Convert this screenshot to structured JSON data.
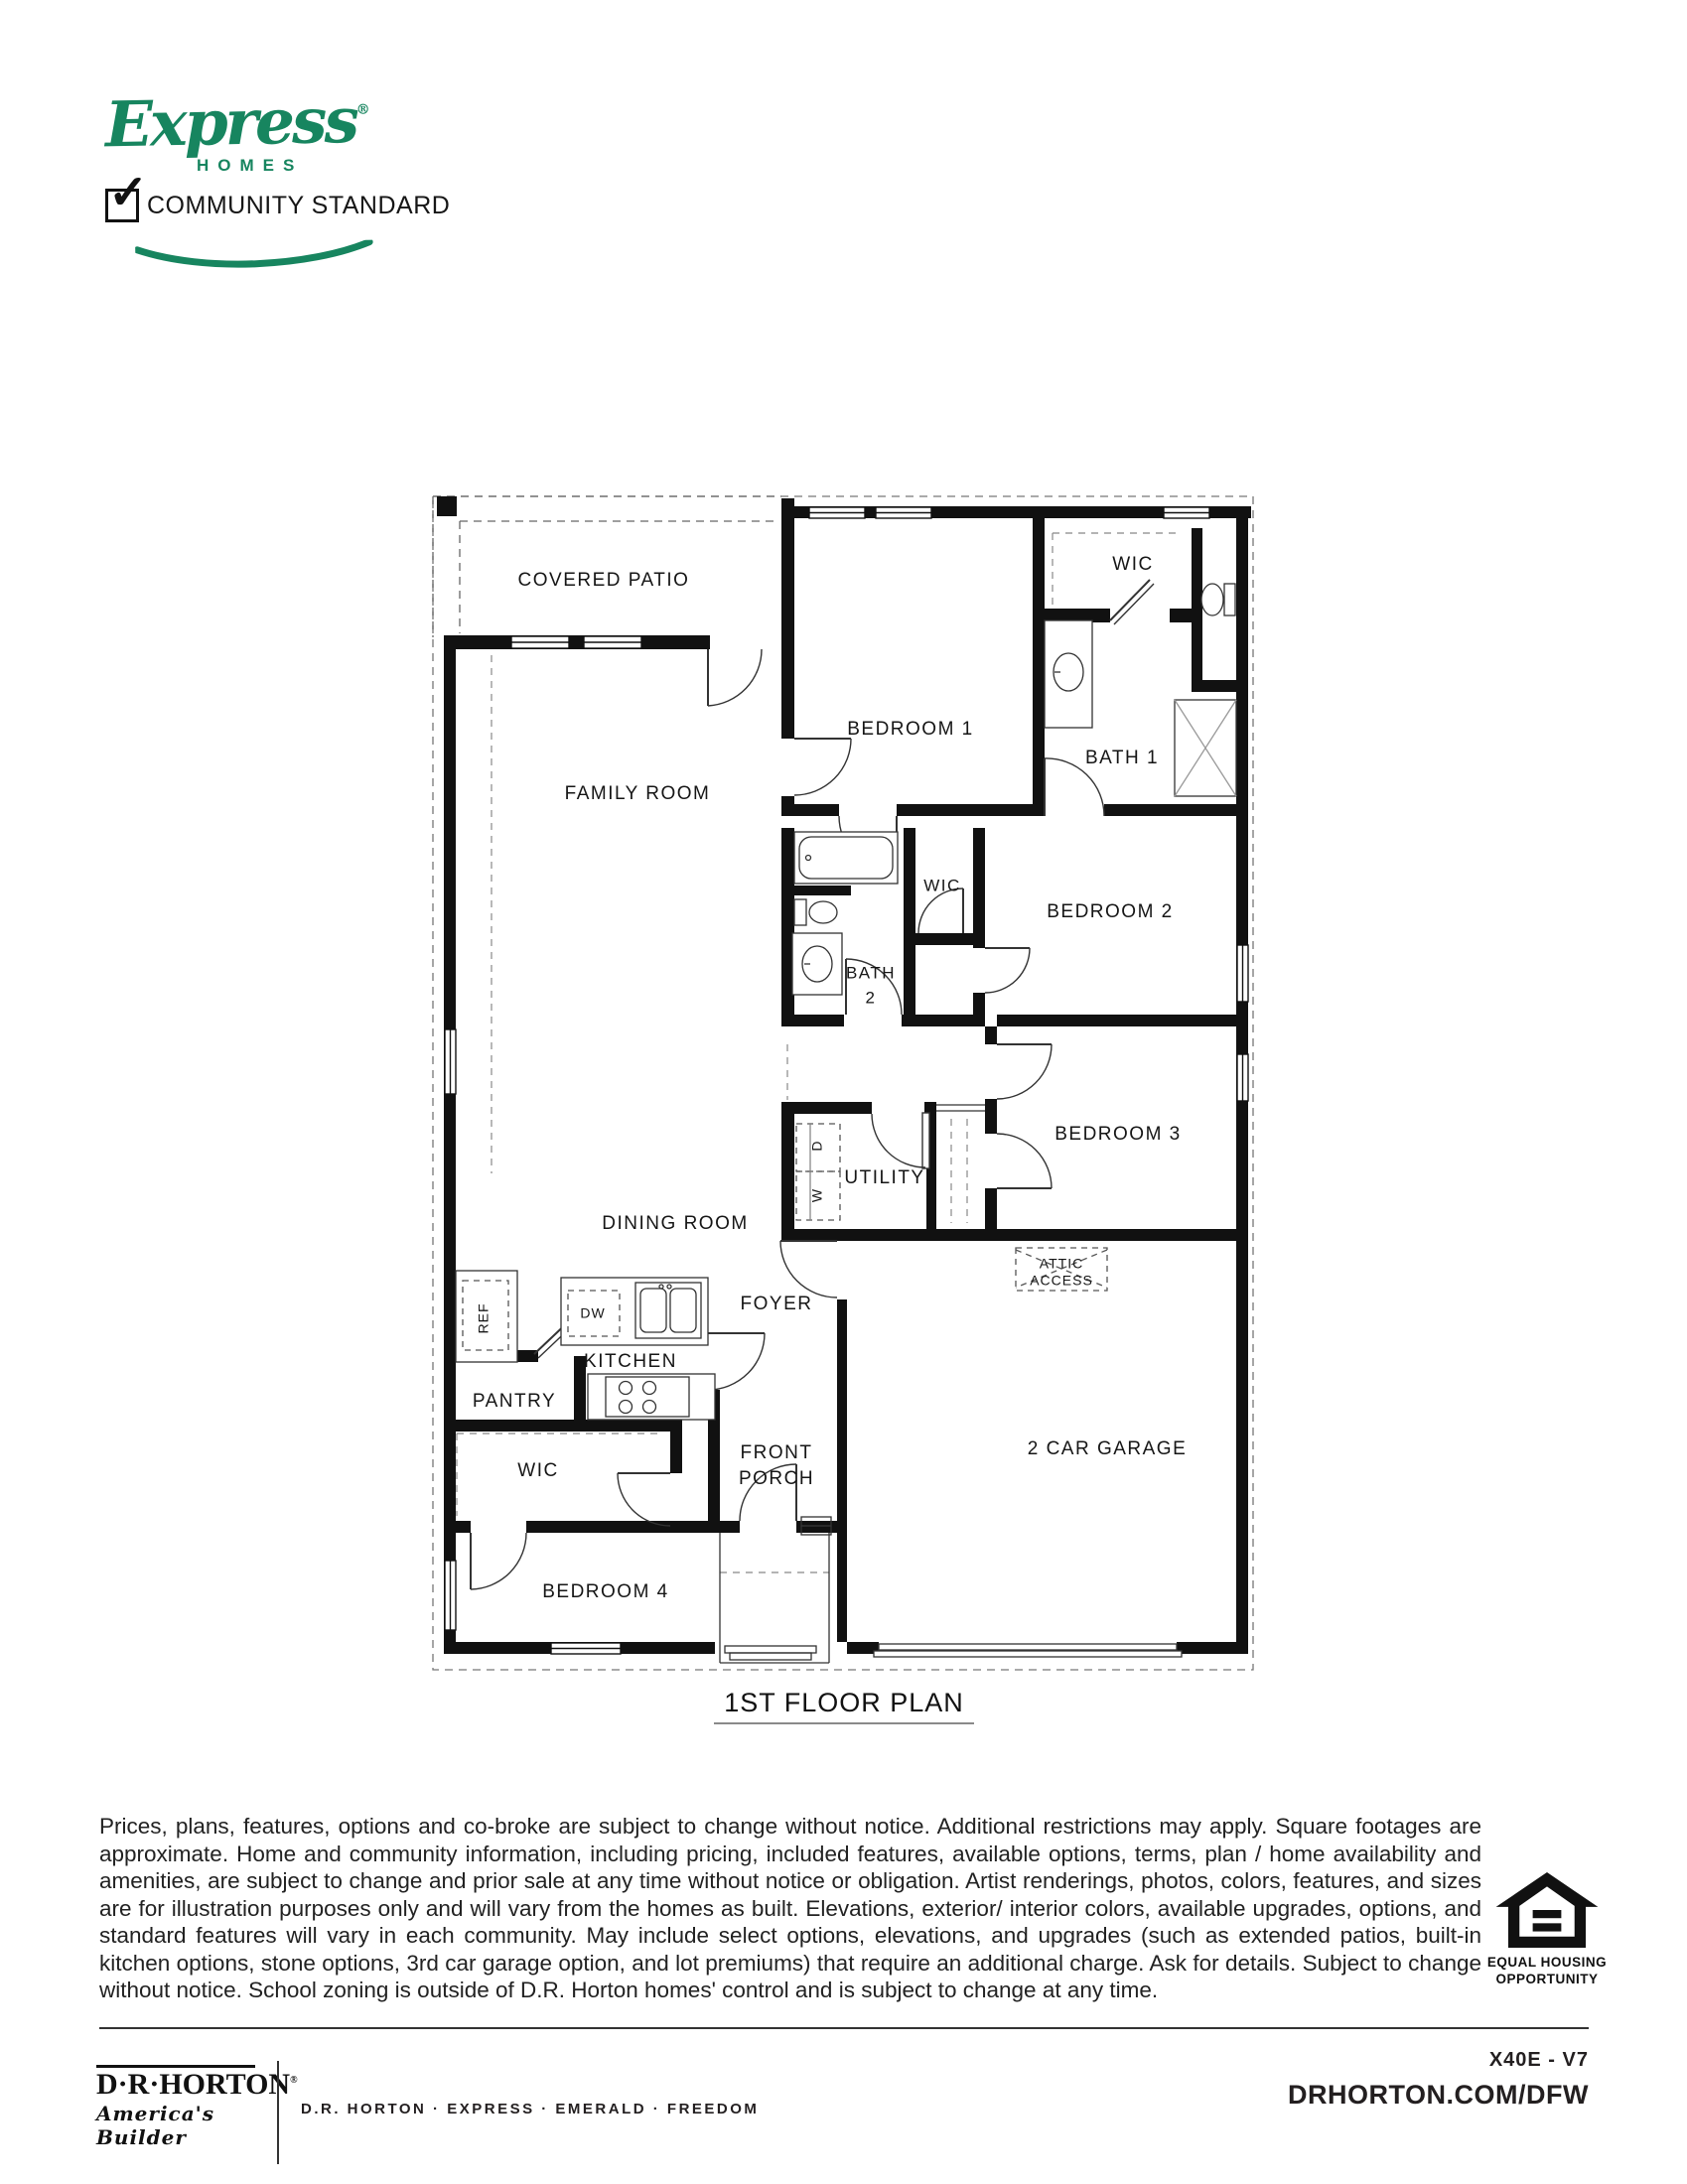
{
  "header": {
    "brand_script": "Express",
    "brand_reg": "®",
    "brand_sub": "HOMES",
    "checkmark": "✓",
    "community_label": "COMMUNITY STANDARD"
  },
  "plan": {
    "title": "1ST FLOOR PLAN",
    "rooms": {
      "covered_patio": "COVERED PATIO",
      "family_room": "FAMILY ROOM",
      "bedroom1": "BEDROOM 1",
      "wic_primary": "WIC",
      "bath1": "BATH 1",
      "bath2_line1": "BATH",
      "bath2_line2": "2",
      "wic_hall": "WIC",
      "bedroom2": "BEDROOM 2",
      "dining_room": "DINING ROOM",
      "bedroom3": "BEDROOM 3",
      "utility": "UTILITY",
      "dryer": "D",
      "washer": "W",
      "ref": "REF",
      "dw": "DW",
      "kitchen": "KITCHEN",
      "pantry": "PANTRY",
      "foyer": "FOYER",
      "attic_line1": "ATTIC",
      "attic_line2": "ACCESS",
      "wic_bedroom4": "WIC",
      "front_porch_line1": "FRONT",
      "front_porch_line2": "PORCH",
      "garage": "2 CAR GARAGE",
      "bedroom4": "BEDROOM 4"
    }
  },
  "disclaimer": "Prices, plans, features, options and co-broke are subject to change without notice. Additional restrictions may apply.  Square footages are approximate. Home and community information, including pricing, included features, available options, terms, plan / home availability and amenities, are subject to change and prior sale at any time without notice or obligation. Artist renderings, photos, colors, features, and sizes are for illustration purposes only and will vary from the homes as built. Elevations, exterior/ interior colors, available upgrades, options, and standard features will vary in each community. May include select options, elevations, and upgrades (such as extended patios, built-in kitchen options, stone options, 3rd car garage option, and lot premiums) that require an additional charge. Ask for details. Subject to change without notice. School zoning is outside of D.R. Horton homes' control and is subject to change at any time.",
  "eho": {
    "line1": "EQUAL HOUSING",
    "line2": "OPPORTUNITY"
  },
  "footer": {
    "logo_name": "D·R·HORTON",
    "logo_reg": "®",
    "logo_tagline": "America's Builder",
    "brands": "D.R. HORTON · EXPRESS · EMERALD · FREEDOM",
    "plan_code": "X40E - V7",
    "website": "DRHORTON.COM/DFW"
  },
  "colors": {
    "brand_green": "#17855F",
    "ink": "#231F20"
  }
}
